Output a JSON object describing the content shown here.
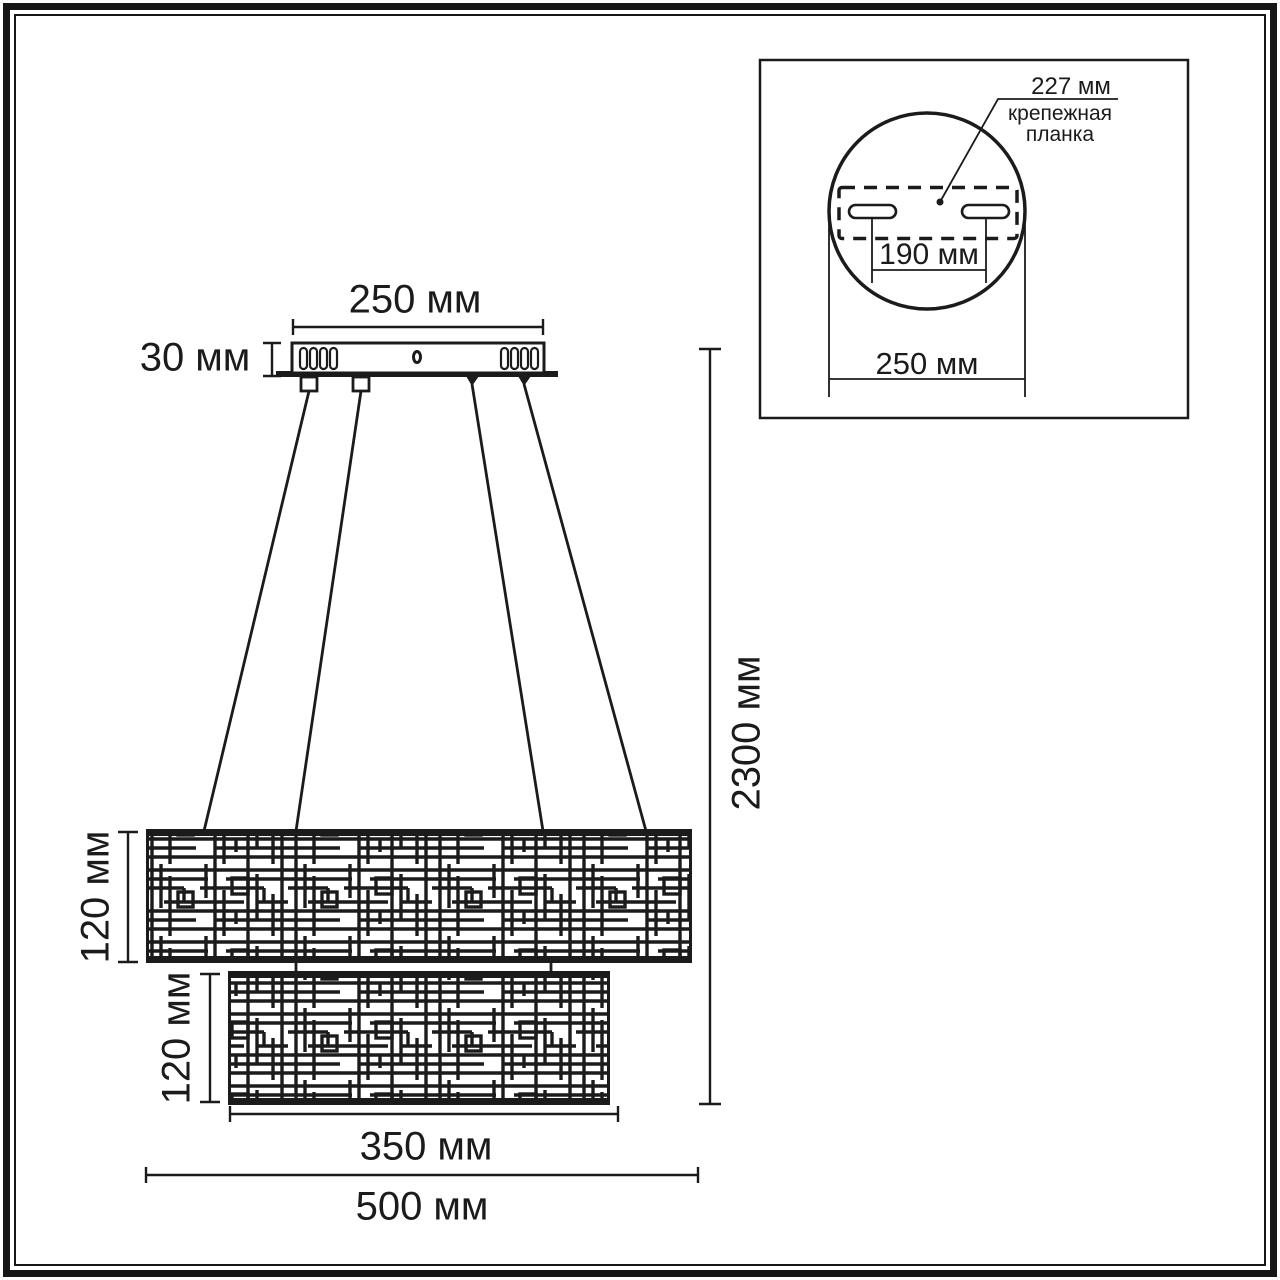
{
  "colors": {
    "line": "#1b1b1b",
    "background": "#ffffff"
  },
  "main": {
    "dim_canopy_width": "250 мм",
    "dim_canopy_height": "30 мм",
    "dim_total_drop": "2300 мм",
    "dim_tier1_height": "120 мм",
    "dim_tier2_height": "120 мм",
    "dim_tier2_width": "350 мм",
    "dim_tier1_width": "500 мм"
  },
  "inset": {
    "dim_bracket_length": "227 мм",
    "bracket_label_line1": "крепежная",
    "bracket_label_line2": "планка",
    "dim_slot_spacing": "190 мм",
    "dim_canopy_diameter": "250 мм"
  }
}
